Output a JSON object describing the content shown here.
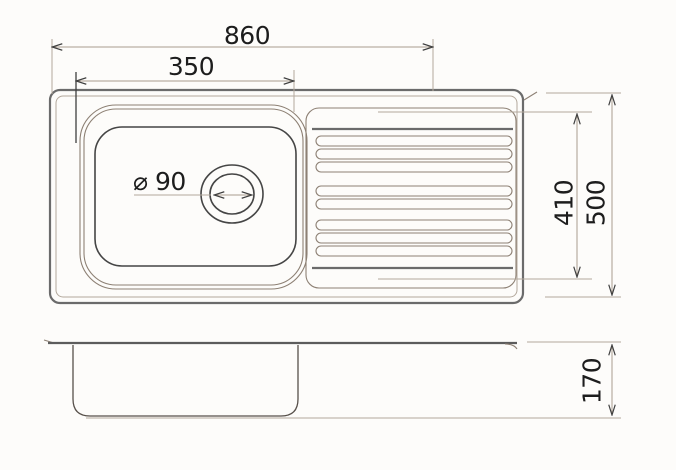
{
  "drawing": {
    "subject": "kitchen sink technical drawing, top view and side view"
  },
  "dimensions": {
    "overall_width": "860",
    "bowl_width": "350",
    "drain_diameter": "⌀ 90",
    "drainer_length": "410",
    "overall_depth": "500",
    "bowl_depth": "170"
  },
  "colors": {
    "background": "#fdfcfa",
    "outline_strong": "#6b6b6b",
    "outline_bowl": "#454545",
    "outline_light": "#b3a89c",
    "dimension_line": "#a99c8e",
    "arrow": "#3f3f3f",
    "text": "#1d1d1d"
  }
}
